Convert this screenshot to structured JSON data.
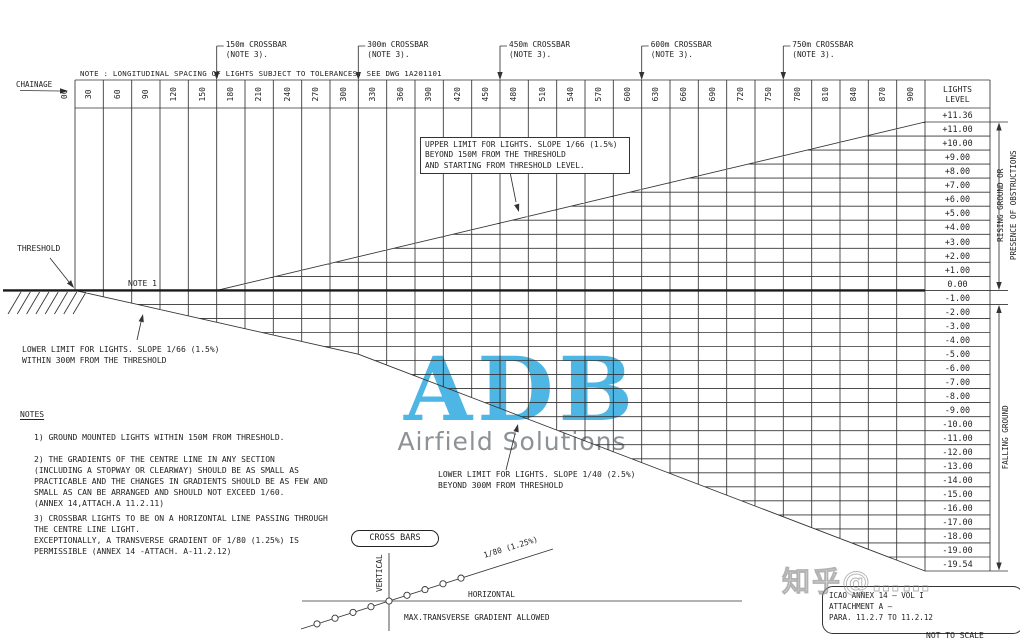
{
  "title_note": "NOTE : LONGITUDINAL SPACING OF LIGHTS SUBJECT TO TOLERANCES. SEE DWG 1A201101",
  "chainage": {
    "label": "CHAINAGE",
    "zero": "00",
    "values": [
      "30",
      "60",
      "90",
      "120",
      "150",
      "180",
      "210",
      "240",
      "270",
      "300",
      "330",
      "360",
      "390",
      "420",
      "450",
      "480",
      "510",
      "540",
      "570",
      "600",
      "630",
      "660",
      "690",
      "720",
      "750",
      "780",
      "810",
      "840",
      "870",
      "900"
    ]
  },
  "scale": {
    "header": "LIGHTS\nLEVEL",
    "levels": [
      "+11.36",
      "+11.00",
      "+10.00",
      "+9.00",
      "+8.00",
      "+7.00",
      "+6.00",
      "+5.00",
      "+4.00",
      "+3.00",
      "+2.00",
      "+1.00",
      "0.00",
      "-1.00",
      "-2.00",
      "-3.00",
      "-4.00",
      "-5.00",
      "-6.00",
      "-7.00",
      "-8.00",
      "-9.00",
      "-10.00",
      "-11.00",
      "-12.00",
      "-13.00",
      "-14.00",
      "-15.00",
      "-16.00",
      "-17.00",
      "-18.00",
      "-19.00",
      "-19.54"
    ]
  },
  "crossbars": {
    "positions_m": [
      150,
      300,
      450,
      600,
      750
    ],
    "labels": [
      "150m CROSSBAR",
      "300m CROSSBAR",
      "450m CROSSBAR",
      "600m CROSSBAR",
      "750m CROSSBAR"
    ],
    "note": "(NOTE 3)."
  },
  "annotations": {
    "threshold": "THRESHOLD",
    "note1": "NOTE 1",
    "upper_limit": "UPPER LIMIT FOR LIGHTS. SLOPE 1/66 (1.5%)\nBEYOND 150M FROM THE THRESHOLD\nAND STARTING FROM THRESHOLD LEVEL.",
    "lower_limit_near": "LOWER LIMIT FOR LIGHTS. SLOPE 1/66 (1.5%)\nWITHIN 300M FROM THE THRESHOLD",
    "lower_limit_far": "LOWER LIMIT FOR LIGHTS. SLOPE 1/40 (2.5%)\nBEYOND 300M FROM THRESHOLD",
    "rising": "RISING GROUND OR",
    "presence": "PRESENCE OF OBSTRUCTIONS",
    "falling": "FALLING GROUND"
  },
  "notes": {
    "title": "NOTES",
    "items": [
      "1) GROUND MOUNTED LIGHTS WITHIN 150M FROM THRESHOLD.",
      "2) THE GRADIENTS OF THE CENTRE LINE IN ANY SECTION\n(INCLUDING A STOPWAY OR CLEARWAY) SHOULD BE AS SMALL AS\nPRACTICABLE AND THE CHANGES IN GRADIENTS SHOULD BE AS FEW AND\nSMALL AS CAN BE ARRANGED AND SHOULD NOT EXCEED 1/60.\n(ANNEX 14,ATTACH.A 11.2.11)",
      "3) CROSSBAR LIGHTS TO BE ON A HORIZONTAL LINE PASSING THROUGH\nTHE CENTRE LINE LIGHT.\nEXCEPTIONALLY, A TRANSVERSE GRADIENT OF 1/80 (1.25%) IS\nPERMISSIBLE (ANNEX 14 -ATTACH. A-11.2.12)"
    ]
  },
  "cross_bars_box": "CROSS BARS",
  "mini": {
    "vertical": "VERTICAL",
    "horizontal": "HORIZONTAL",
    "slope": "1/80 (1.25%)",
    "caption": "MAX.TRANSVERSE GRADIENT ALLOWED"
  },
  "logo": {
    "name": "ADB",
    "tagline": "Airfield Solutions",
    "color": "#4eb6e4",
    "tagline_color": "#8d9296"
  },
  "title_block": {
    "text": "ICAO ANNEX 14 — VOL I\nATTACHMENT A —\nPARA. 11.2.7 TO 11.2.12",
    "footer": "NOT TO SCALE"
  },
  "watermark": "知乎@……",
  "chart_data": {
    "type": "line",
    "title": "APPROACH LIGHTS LEVEL ENVELOPE",
    "xlabel": "CHAINAGE (m)",
    "ylabel": "LIGHTS LEVEL (m)",
    "x_range": [
      0,
      900
    ],
    "y_range": [
      -19.54,
      11.36
    ],
    "x_ticks_interval_m": 30,
    "series": [
      {
        "name": "UPPER LIMIT FOR LIGHTS, SLOPE 1/66 (1.5%)",
        "points": [
          [
            150,
            0.0
          ],
          [
            900,
            11.36
          ]
        ]
      },
      {
        "name": "LOWER LIMIT FOR LIGHTS WITHIN 300M, SLOPE 1/66 (1.5%)",
        "points": [
          [
            0,
            0.0
          ],
          [
            300,
            -4.55
          ]
        ]
      },
      {
        "name": "LOWER LIMIT FOR LIGHTS BEYOND 300M, SLOPE 1/40 (2.5%)",
        "points": [
          [
            300,
            -4.55
          ],
          [
            900,
            -19.54
          ]
        ]
      },
      {
        "name": "THRESHOLD / CENTRE LINE LEVEL",
        "points": [
          [
            0,
            0.0
          ],
          [
            900,
            0.0
          ]
        ]
      }
    ],
    "crossbar_positions_m": [
      150,
      300,
      450,
      600,
      750
    ],
    "max_transverse_gradient": "1/80 (1.25%)"
  }
}
